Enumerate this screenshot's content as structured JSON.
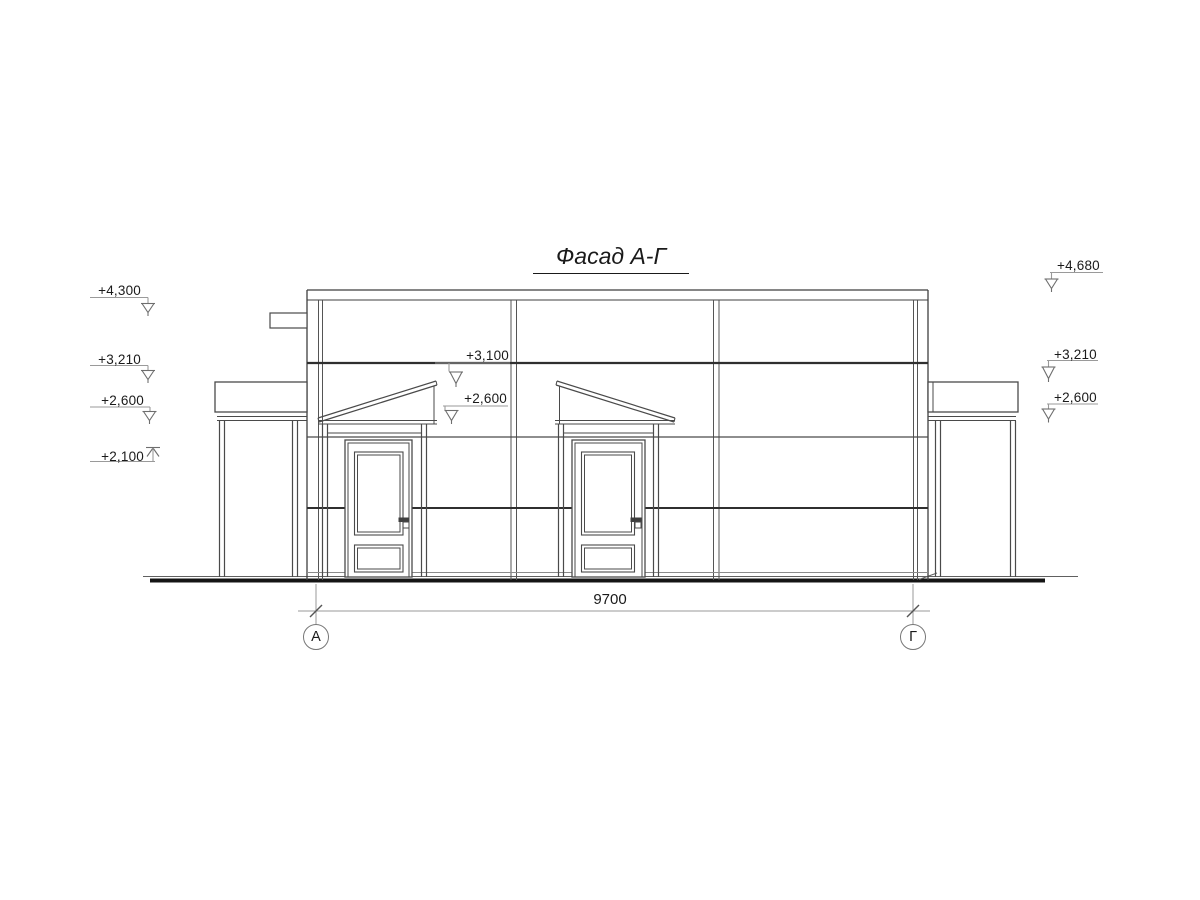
{
  "title": "Фасад А-Г",
  "elevation_marks": {
    "left": [
      {
        "label": "+4,300"
      },
      {
        "label": "+3,210"
      },
      {
        "label": "+2,600"
      },
      {
        "label": "+2,100"
      }
    ],
    "middle": [
      {
        "label": "+3,100"
      },
      {
        "label": "+2,600"
      }
    ],
    "right": [
      {
        "label": "+4,680"
      },
      {
        "label": "+3,210"
      },
      {
        "label": "+2,600"
      }
    ]
  },
  "dimension": {
    "value": "9700"
  },
  "axes": [
    {
      "label": "А"
    },
    {
      "label": "Г"
    }
  ],
  "colors": {
    "line": "#3f3f3f",
    "thick_line": "#2f2f2f",
    "light_line": "#9a9a9a",
    "ground_line": "#151515",
    "text": "#1a1a1a",
    "background": "#ffffff"
  }
}
